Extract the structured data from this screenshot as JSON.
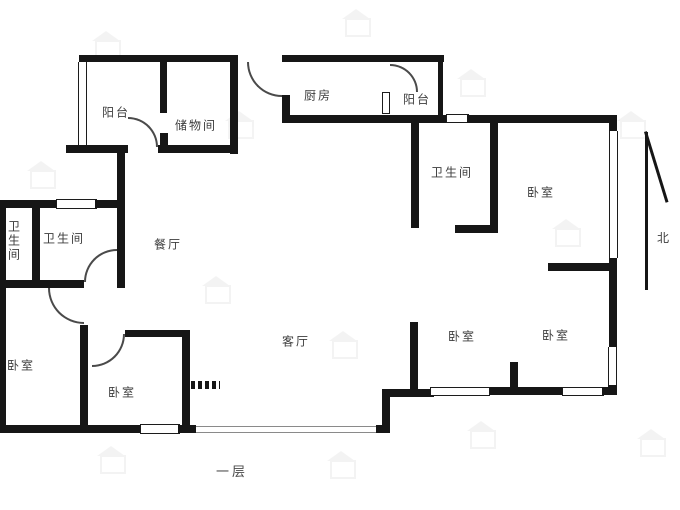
{
  "caption": "一层",
  "compass": {
    "label": "北"
  },
  "colors": {
    "wall": "#161616",
    "label": "#3d3d3d",
    "arc": "#4a4a4a"
  },
  "rooms": [
    {
      "name": "balcony-left",
      "label": "阳台",
      "x": 116,
      "y": 112,
      "vertical": false
    },
    {
      "name": "storage-room",
      "label": "储物间",
      "x": 196,
      "y": 125,
      "vertical": false
    },
    {
      "name": "kitchen",
      "label": "厨房",
      "x": 318,
      "y": 95,
      "vertical": false
    },
    {
      "name": "balcony-right",
      "label": "阳台",
      "x": 417,
      "y": 99,
      "vertical": false
    },
    {
      "name": "bathroom-right",
      "label": "卫生间",
      "x": 452,
      "y": 172,
      "vertical": false
    },
    {
      "name": "bedroom-top-right",
      "label": "卧室",
      "x": 541,
      "y": 192,
      "vertical": false
    },
    {
      "name": "bathroom-left-small",
      "label": "卫生间",
      "x": 14,
      "y": 241,
      "vertical": true
    },
    {
      "name": "bathroom-left",
      "label": "卫生间",
      "x": 64,
      "y": 238,
      "vertical": false
    },
    {
      "name": "dining-room",
      "label": "餐厅",
      "x": 168,
      "y": 244,
      "vertical": false
    },
    {
      "name": "bedroom-far-left",
      "label": "卧室",
      "x": 21,
      "y": 365,
      "vertical": false
    },
    {
      "name": "bedroom-center",
      "label": "卧室",
      "x": 122,
      "y": 392,
      "vertical": false
    },
    {
      "name": "living-room",
      "label": "客厅",
      "x": 296,
      "y": 341,
      "vertical": false
    },
    {
      "name": "bedroom-bottom-mid",
      "label": "卧室",
      "x": 462,
      "y": 336,
      "vertical": false
    },
    {
      "name": "bedroom-bottom-right",
      "label": "卧室",
      "x": 556,
      "y": 335,
      "vertical": false
    }
  ]
}
